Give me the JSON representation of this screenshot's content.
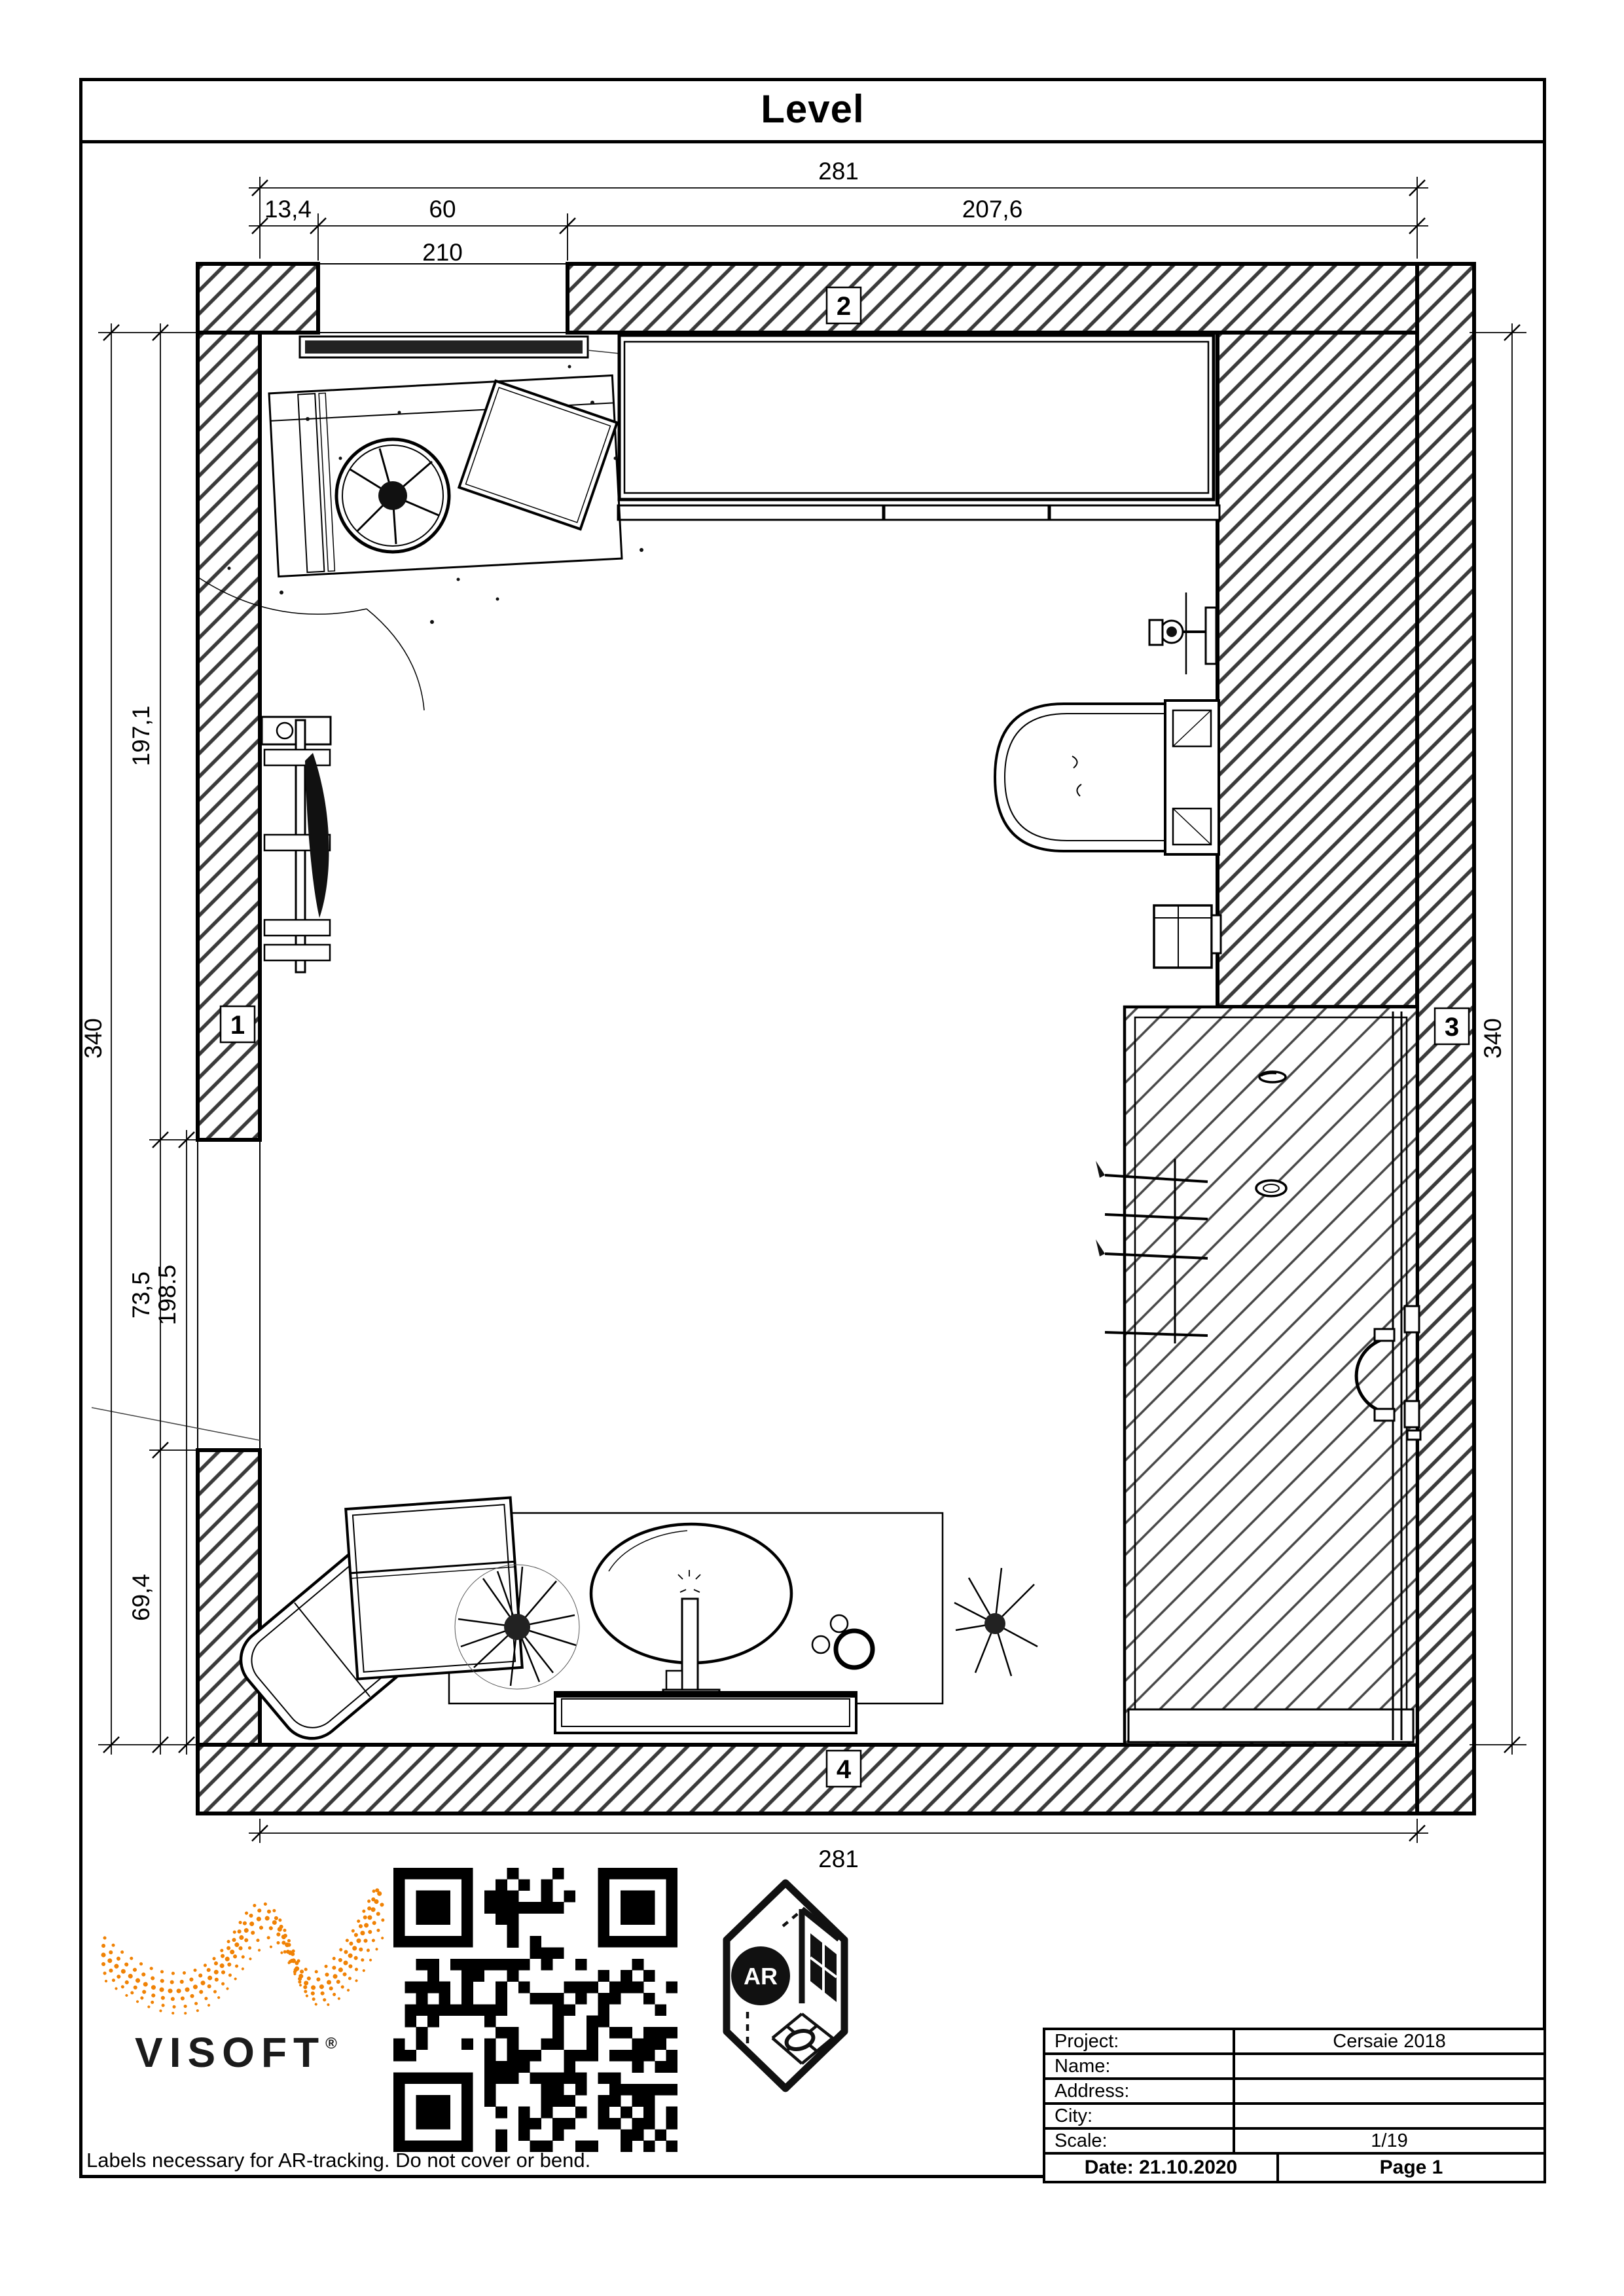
{
  "page": {
    "title": "Level"
  },
  "plan": {
    "markers": {
      "m1": "1",
      "m2": "2",
      "m3": "3",
      "m4": "4"
    },
    "dims": {
      "top": {
        "overall": "281",
        "seg1": "13,4",
        "seg2": "60",
        "seg3": "207,6",
        "below": "210"
      },
      "left": {
        "outer": "340",
        "seg1": "197,1",
        "seg2": "73,5",
        "seg3": "69,4",
        "extra": "198.5"
      },
      "right": {
        "outer": "340"
      },
      "bottom": {
        "overall": "281"
      }
    }
  },
  "branding": {
    "logo_text": "VISOFT",
    "registered_mark": "®",
    "ar_label": "AR"
  },
  "footer": {
    "note": "Labels necessary for AR-tracking. Do not cover or bend."
  },
  "info_table": {
    "rows": [
      {
        "label": "Project:",
        "value": "Cersaie 2018"
      },
      {
        "label": "Name:",
        "value": ""
      },
      {
        "label": "Address:",
        "value": ""
      },
      {
        "label": "City:",
        "value": ""
      },
      {
        "label": "Scale:",
        "value": "1/19"
      }
    ],
    "date": "Date: 21.10.2020",
    "page": "Page 1"
  },
  "colors": {
    "accent_orange": "#F08205",
    "hatch_dark": "#3a3a3a",
    "line_black": "#000000"
  }
}
